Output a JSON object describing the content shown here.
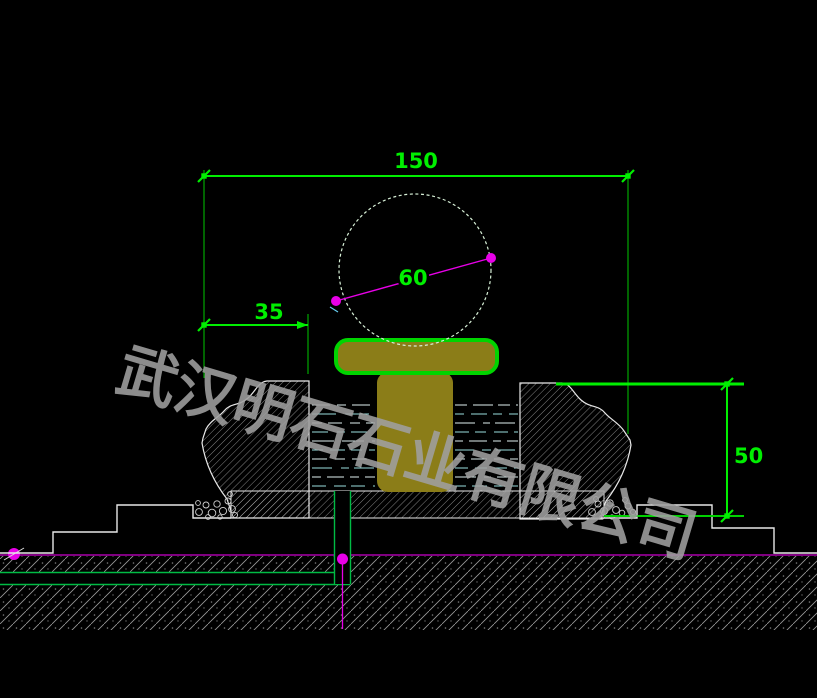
{
  "dimensions": {
    "total_width": "150",
    "ball_diameter": "60",
    "rim_width": "35",
    "basin_height": "50"
  },
  "watermark": {
    "text": "武汉明石石业有限公司"
  },
  "colors": {
    "background": "#000000",
    "dimension_green": "#00ef00",
    "centerline_magenta": "#e800e8",
    "outline_white": "#e8e8e8",
    "stone_olive": "#8b7d18",
    "collar_green": "#00d400",
    "water_cyan": "#9adede",
    "ground_line_magenta": "#cc00cc",
    "watermark_gray": "#a0a0a0"
  }
}
